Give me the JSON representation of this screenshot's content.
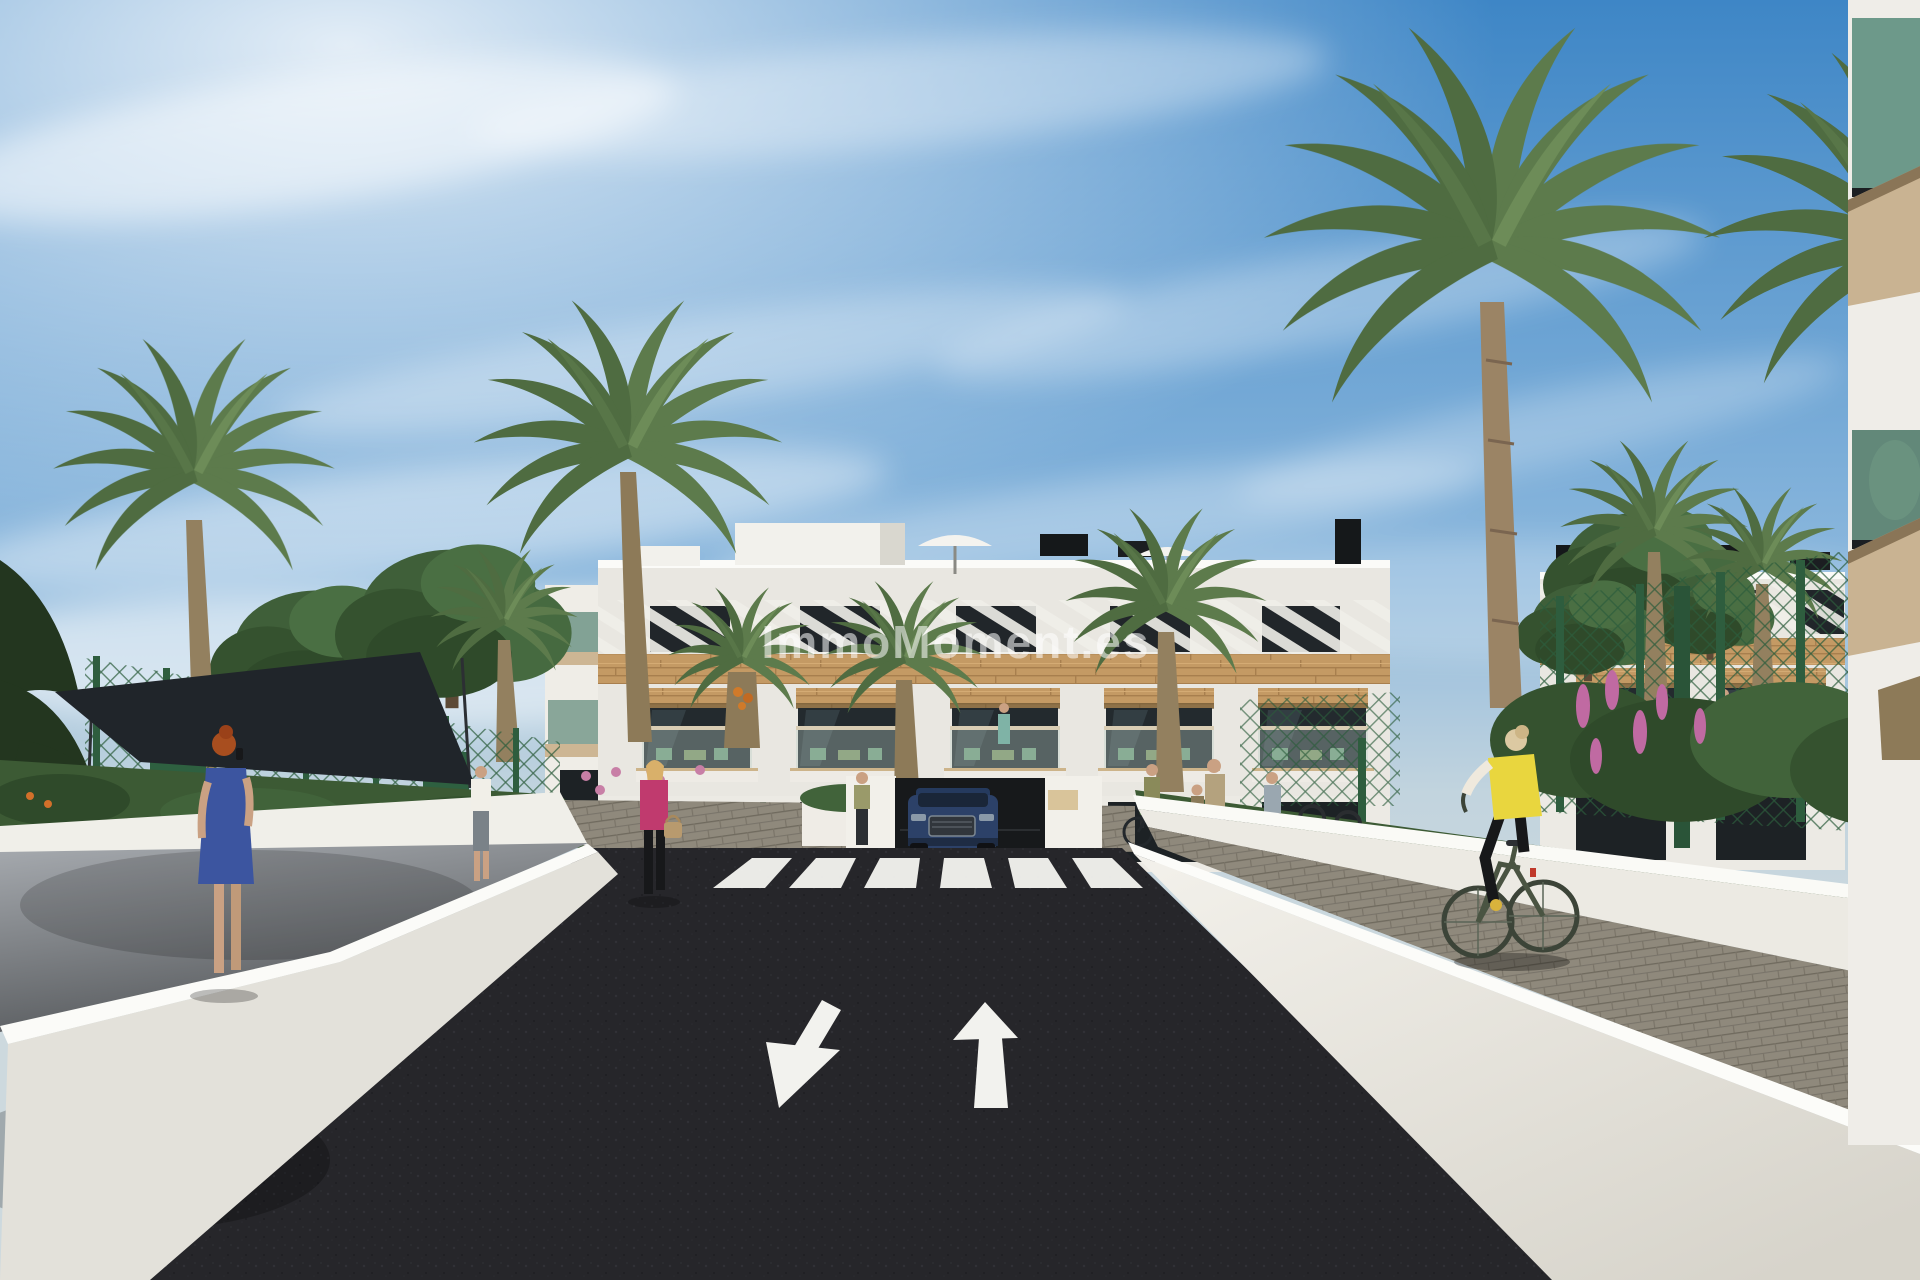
{
  "meta": {
    "width": 1920,
    "height": 1280,
    "kind": "architectural-render"
  },
  "watermark": {
    "text": "ImmoMoment.es"
  },
  "palette": {
    "sky_top": "#3e86c6",
    "sky_mid": "#8cb8dd",
    "sky_horizon": "#cdd9de",
    "asphalt": "#26262a",
    "road_marking": "#f2f2ee",
    "wall_white": "#f0efe9",
    "wall_cap": "#fbfbf8",
    "paver_grey": "#8f897c",
    "walkway_grey": "#84888c",
    "wood": "#c49a64",
    "glass_dark": "#232a2e",
    "balcony_glass_green": "#5e8f80",
    "palm_green": "#5d7b4c",
    "tree_green": "#3f5f39",
    "fence_green": "#2e5d3e",
    "car_blue": "#2c4168",
    "vest_yellow": "#e9d63e",
    "dress_blue": "#3c55a0",
    "jacket_pink": "#c03a6e",
    "flower_pink": "#c06aa2",
    "flower_orange": "#d2702a",
    "sail_dark": "#20252a"
  }
}
